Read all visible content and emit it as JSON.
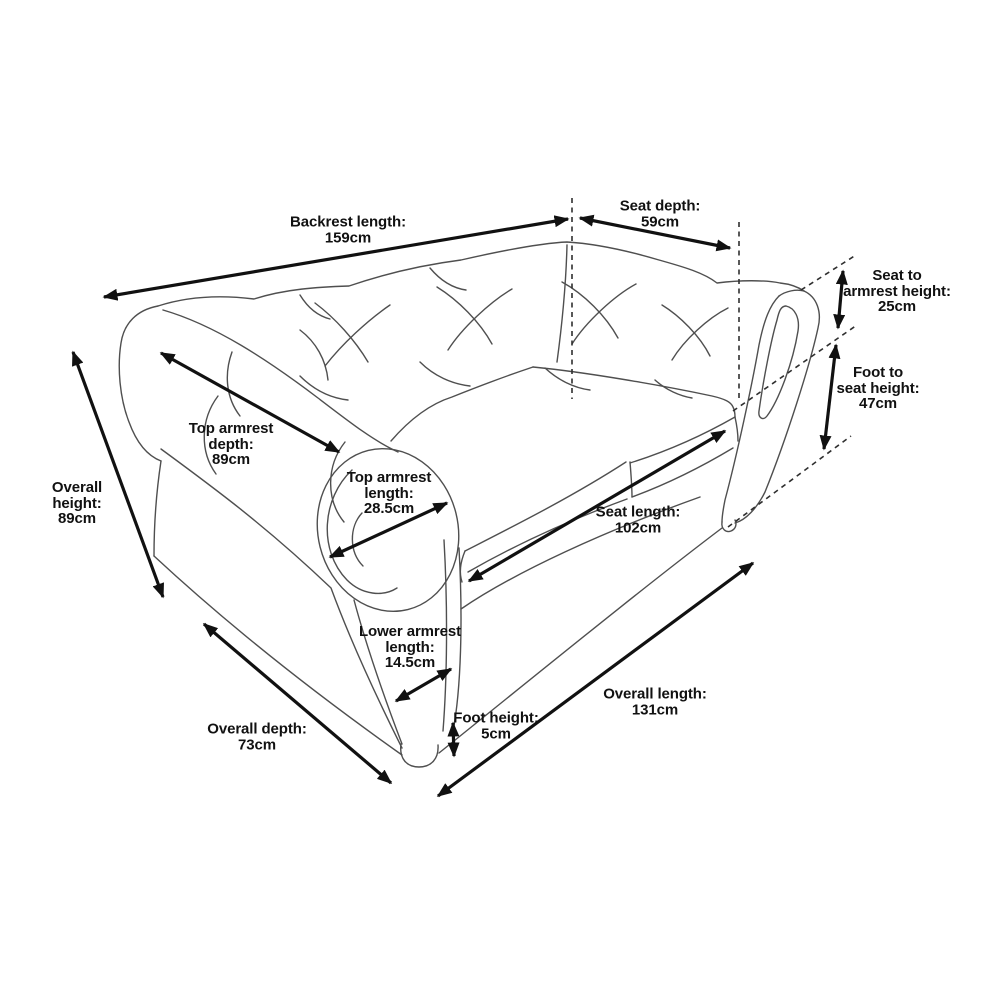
{
  "illustration": {
    "name": "chesterfield-two-seater-sofa-line-drawing",
    "style": "perspective outline sketch with dimension arrows",
    "background_color": "#ffffff",
    "sofa_line_color": "#4f4f4f",
    "arrow_color": "#111111",
    "text_color": "#111111",
    "units": "cm"
  },
  "measurements": [
    {
      "id": "backrest-length",
      "lines": [
        "Backrest length:"
      ],
      "value": "159cm"
    },
    {
      "id": "seat-depth",
      "lines": [
        "Seat depth:"
      ],
      "value": "59cm"
    },
    {
      "id": "seat-to-armrest-height",
      "lines": [
        "Seat to",
        "armrest height:"
      ],
      "value": "25cm"
    },
    {
      "id": "foot-to-seat-height",
      "lines": [
        "Foot to",
        "seat height:"
      ],
      "value": "47cm"
    },
    {
      "id": "overall-height",
      "lines": [
        "Overall",
        "height:"
      ],
      "value": "89cm"
    },
    {
      "id": "top-armrest-depth",
      "lines": [
        "Top armrest",
        "depth:"
      ],
      "value": "89cm"
    },
    {
      "id": "top-armrest-length",
      "lines": [
        "Top armrest",
        "length:"
      ],
      "value": "28.5cm"
    },
    {
      "id": "seat-length",
      "lines": [
        "Seat length:"
      ],
      "value": "102cm"
    },
    {
      "id": "lower-armrest-length",
      "lines": [
        "Lower armrest",
        "length:"
      ],
      "value": "14.5cm"
    },
    {
      "id": "foot-height",
      "lines": [
        "Foot height:"
      ],
      "value": "5cm"
    },
    {
      "id": "overall-length",
      "lines": [
        "Overall length:"
      ],
      "value": "131cm"
    },
    {
      "id": "overall-depth",
      "lines": [
        "Overall depth:"
      ],
      "value": "73cm"
    }
  ]
}
